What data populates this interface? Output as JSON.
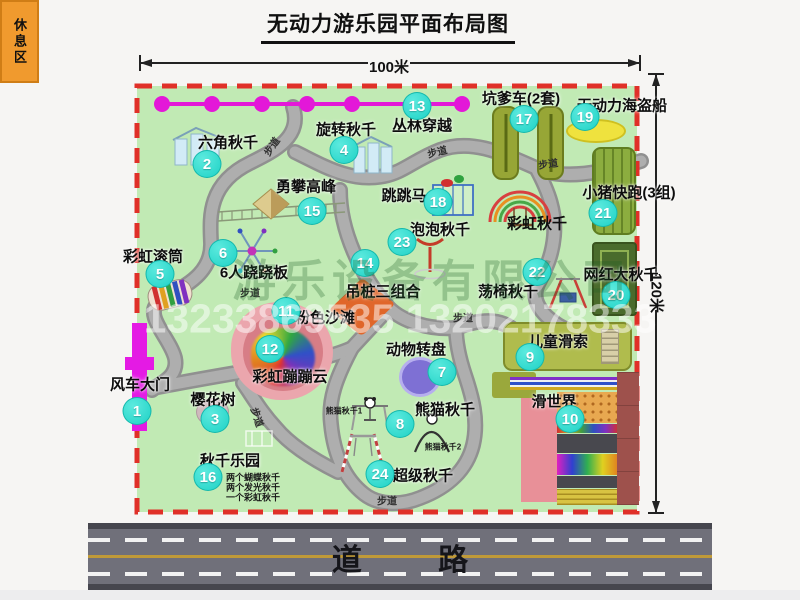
{
  "title": "无动力游乐园平面布局图",
  "dimension_top": "100米",
  "dimension_right": "120米",
  "road_label": "道 路",
  "rest_area_label": "休息区",
  "colors": {
    "park_green": "#c1eab4",
    "border_red": "#e03028",
    "path_gray": "#a8a8a8",
    "marker_cyan": "#1fd2c6",
    "zipline_magenta": "#e318d8",
    "gate_magenta": "#e41ae4",
    "rest_area_orange": "#f09a2e"
  },
  "items": [
    {
      "num": "1",
      "label": "风车大门",
      "mx": 137,
      "my": 411,
      "lx": 140,
      "ly": 384
    },
    {
      "num": "2",
      "label": "六角秋千",
      "mx": 207,
      "my": 164,
      "lx": 228,
      "ly": 142
    },
    {
      "num": "3",
      "label": "樱花树",
      "mx": 215,
      "my": 419,
      "lx": 213,
      "ly": 399
    },
    {
      "num": "4",
      "label": "旋转秋千",
      "mx": 344,
      "my": 150,
      "lx": 346,
      "ly": 129
    },
    {
      "num": "5",
      "label": "彩虹滚筒",
      "mx": 160,
      "my": 274,
      "lx": 153,
      "ly": 256
    },
    {
      "num": "6",
      "label": "6人跷跷板",
      "mx": 223,
      "my": 253,
      "lx": 254,
      "ly": 272
    },
    {
      "num": "7",
      "label": "动物转盘",
      "mx": 442,
      "my": 372,
      "lx": 416,
      "ly": 349
    },
    {
      "num": "8",
      "label": "熊猫秋千",
      "mx": 400,
      "my": 424,
      "lx": 445,
      "ly": 409
    },
    {
      "num": "9",
      "label": "儿童滑索",
      "mx": 530,
      "my": 357,
      "lx": 558,
      "ly": 341
    },
    {
      "num": "10",
      "label": "滑世界",
      "mx": 570,
      "my": 419,
      "lx": 554,
      "ly": 401
    },
    {
      "num": "11",
      "label": "粉色沙滩",
      "mx": 286,
      "my": 311,
      "lx": 325,
      "ly": 317
    },
    {
      "num": "12",
      "label": "彩虹蹦蹦云",
      "mx": 270,
      "my": 349,
      "lx": 290,
      "ly": 376
    },
    {
      "num": "13",
      "label": "丛林穿越",
      "mx": 417,
      "my": 106,
      "lx": 422,
      "ly": 125
    },
    {
      "num": "14",
      "label": "吊桩三组合",
      "mx": 365,
      "my": 263,
      "lx": 383,
      "ly": 291
    },
    {
      "num": "15",
      "label": "勇攀高峰",
      "mx": 312,
      "my": 211,
      "lx": 306,
      "ly": 186
    },
    {
      "num": "16",
      "label": "秋千乐园",
      "mx": 208,
      "my": 477,
      "lx": 230,
      "ly": 460
    },
    {
      "num": "17",
      "label": "坑爹车(2套)",
      "mx": 524,
      "my": 119,
      "lx": 521,
      "ly": 98
    },
    {
      "num": "18",
      "label": "跳跳马",
      "mx": 438,
      "my": 202,
      "lx": 404,
      "ly": 195
    },
    {
      "num": "19",
      "label": "无动力海盗船",
      "mx": 585,
      "my": 117,
      "lx": 622,
      "ly": 105
    },
    {
      "num": "20",
      "label": "网红大秋千",
      "mx": 616,
      "my": 295,
      "lx": 621,
      "ly": 274
    },
    {
      "num": "21",
      "label": "小猪快跑(3组)",
      "mx": 603,
      "my": 213,
      "lx": 629,
      "ly": 192
    },
    {
      "num": "22",
      "label": "荡椅秋千",
      "mx": 537,
      "my": 272,
      "lx": 508,
      "ly": 291
    },
    {
      "num": "23",
      "label": "泡泡秋千",
      "mx": 402,
      "my": 242,
      "lx": 440,
      "ly": 229
    },
    {
      "num": "24",
      "label": "超级秋千",
      "mx": 380,
      "my": 474,
      "lx": 423,
      "ly": 475
    }
  ],
  "floating_labels": [
    {
      "text": "彩虹秋千",
      "x": 537,
      "y": 223,
      "size": 15,
      "color": "#0d0d0d"
    },
    {
      "text": "步道",
      "x": 271,
      "y": 146,
      "size": 10,
      "rot": -55,
      "color": "#2f2f2f"
    },
    {
      "text": "步道",
      "x": 437,
      "y": 151,
      "size": 10,
      "rot": -14,
      "color": "#2f2f2f"
    },
    {
      "text": "步道",
      "x": 548,
      "y": 163,
      "size": 10,
      "rot": -8,
      "color": "#2f2f2f"
    },
    {
      "text": "步道",
      "x": 250,
      "y": 292,
      "size": 10,
      "color": "#2f2f2f"
    },
    {
      "text": "步道",
      "x": 258,
      "y": 417,
      "size": 10,
      "rot": 72,
      "color": "#2f2f2f"
    },
    {
      "text": "步道",
      "x": 463,
      "y": 317,
      "size": 10,
      "color": "#2f2f2f"
    },
    {
      "text": "步道",
      "x": 387,
      "y": 500,
      "size": 10,
      "color": "#2f2f2f"
    },
    {
      "text": "熊猫秋千1",
      "x": 344,
      "y": 411,
      "size": 8,
      "color": "#1a1a1a"
    },
    {
      "text": "熊猫秋千2",
      "x": 443,
      "y": 447,
      "size": 8,
      "color": "#1a1a1a"
    },
    {
      "text": "两个蝴蝶秋千",
      "x": 253,
      "y": 477,
      "size": 9,
      "color": "#1a1a1a"
    },
    {
      "text": "两个发光秋千",
      "x": 253,
      "y": 487,
      "size": 9,
      "color": "#1a1a1a"
    },
    {
      "text": "一个彩虹秋千",
      "x": 253,
      "y": 497,
      "size": 9,
      "color": "#1a1a1a"
    },
    {
      "text": "游乐设备有限公司",
      "x": 432,
      "y": 277,
      "size": 44,
      "color": "rgba(30,95,35,0.28)",
      "spacing": 6,
      "wm": true
    },
    {
      "text": "13233869535 13202178333",
      "x": 400,
      "y": 319,
      "size": 41,
      "color": "rgba(255,255,255,0.5)",
      "wm": true
    }
  ]
}
